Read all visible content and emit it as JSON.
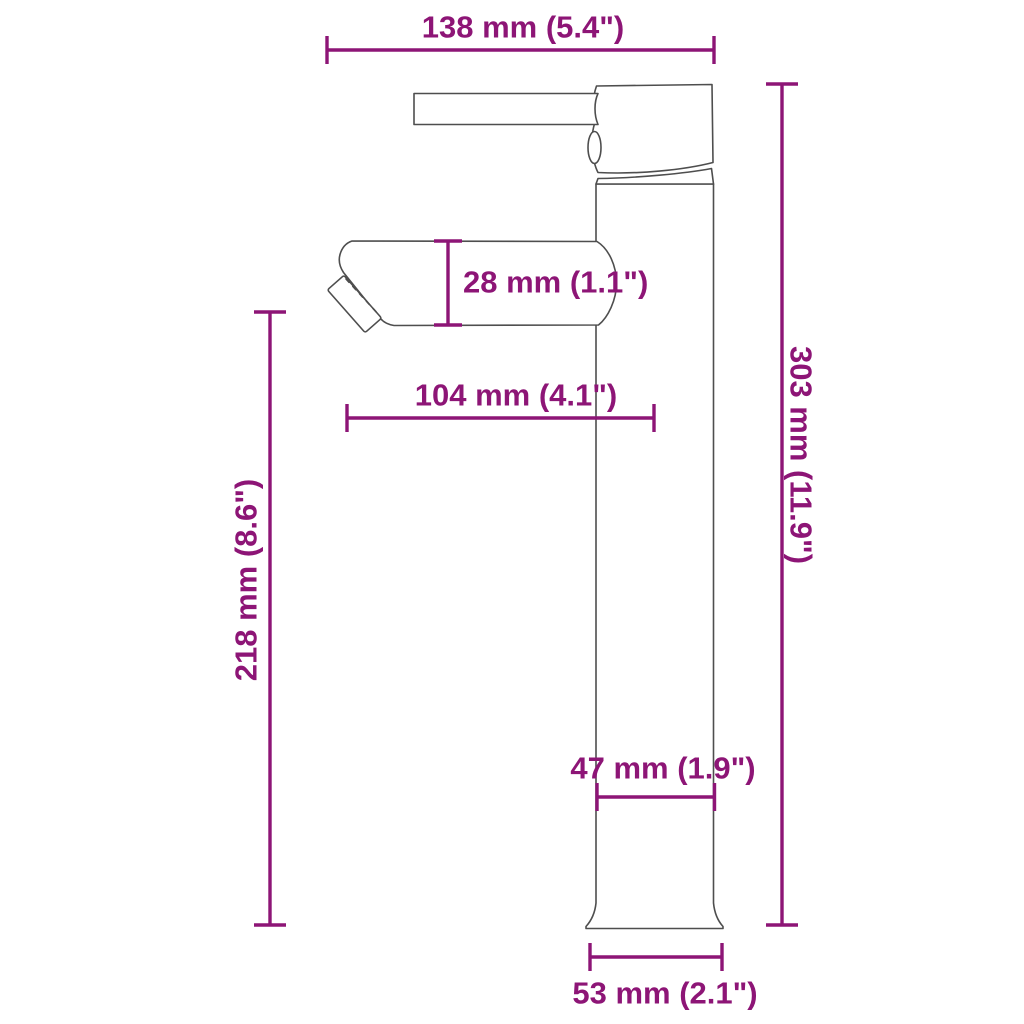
{
  "drawing": {
    "subject": "Single-lever tall vessel basin faucet, side view dimension diagram",
    "accent_color": "#8d1576",
    "line_color": "#4e4e4e",
    "background": "#ffffff"
  },
  "dimensions": {
    "total_width": {
      "label": "138 mm (5.4\")",
      "mm": 138,
      "inches": 5.4,
      "orientation": "horizontal",
      "position": "top"
    },
    "overall_height": {
      "label": "303 mm (11.9\")",
      "mm": 303,
      "inches": 11.9,
      "orientation": "vertical",
      "position": "right"
    },
    "spout_height": {
      "label": "218 mm (8.6\")",
      "mm": 218,
      "inches": 8.6,
      "orientation": "vertical",
      "position": "left"
    },
    "spout_thickness": {
      "label": "28 mm (1.1\")",
      "mm": 28,
      "inches": 1.1,
      "orientation": "vertical",
      "position": "at spout"
    },
    "spout_reach": {
      "label": "104 mm (4.1\")",
      "mm": 104,
      "inches": 4.1,
      "orientation": "horizontal",
      "position": "below spout"
    },
    "body_width": {
      "label": "47 mm (1.9\")",
      "mm": 47,
      "inches": 1.9,
      "orientation": "horizontal",
      "position": "on column"
    },
    "base_width": {
      "label": "53 mm (2.1\")",
      "mm": 53,
      "inches": 2.1,
      "orientation": "horizontal",
      "position": "bottom"
    }
  }
}
